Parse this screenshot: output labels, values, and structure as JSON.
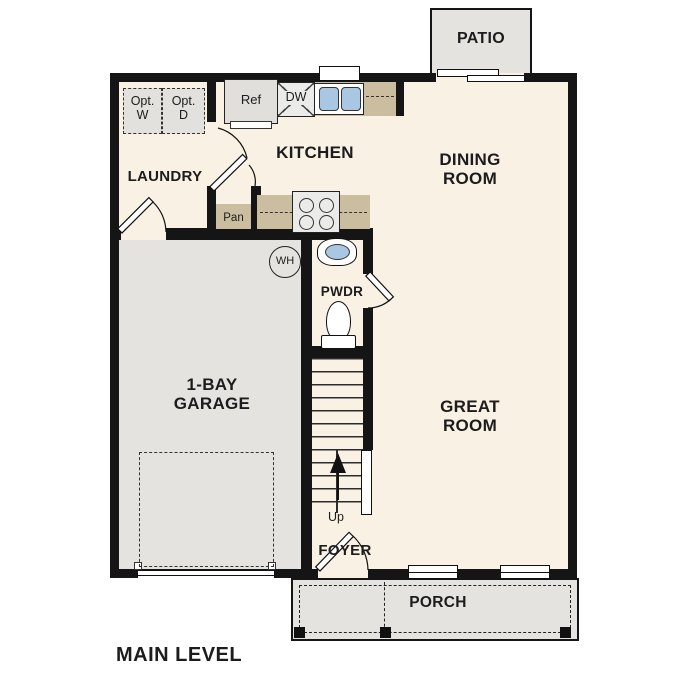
{
  "plan": {
    "title": "MAIN LEVEL",
    "level_type": "floor-plan"
  },
  "rooms": {
    "patio": "PATIO",
    "laundry": "LAUNDRY",
    "kitchen": "KITCHEN",
    "dining_room": "DINING\nROOM",
    "great_room": "GREAT\nROOM",
    "garage": "1-BAY\nGARAGE",
    "powder_room": "PWDR",
    "foyer": "FOYER",
    "porch": "PORCH"
  },
  "fixtures": {
    "refrigerator": "Ref",
    "dishwasher": "DW",
    "pantry": "Pan",
    "water_heater": "WH",
    "optional_washer": "Opt.\nW",
    "optional_dryer": "Opt.\nD",
    "stairs_direction": "Up"
  },
  "colors": {
    "floor": "#F8F1E4",
    "garage": "#E4E3E0",
    "counter": "#CBBD9F",
    "sinkblue": "#A9C6E3",
    "optbox": "#E2E1DE",
    "stove": "#EBEBE9",
    "wall": "#151515"
  }
}
